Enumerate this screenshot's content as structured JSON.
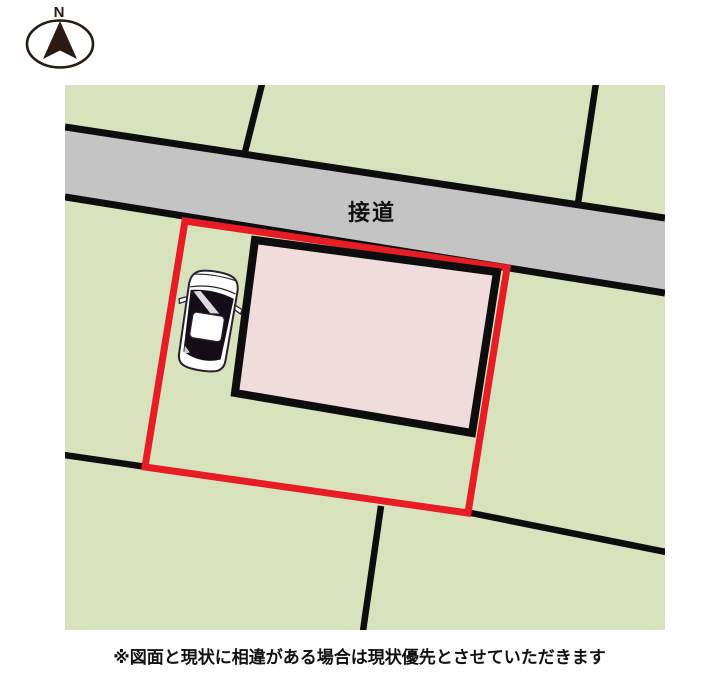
{
  "compass": {
    "label": "N"
  },
  "map": {
    "road_label": "接道",
    "colors": {
      "land": "#d8e3bd",
      "road": "#c4c4c4",
      "line": "#0d0d0d",
      "plot_outline": "#e81c24",
      "building_fill": "#f0dcdd",
      "building_border": "#0d0d0d",
      "car_body": "#ffffff",
      "car_glass": "#140d18",
      "car_outline": "#2b2133",
      "compass": "#2a1a12",
      "label_text": "#111111"
    }
  },
  "caption": {
    "text": "※図面と現状に相違がある場合は現状優先とさせていただきます"
  }
}
